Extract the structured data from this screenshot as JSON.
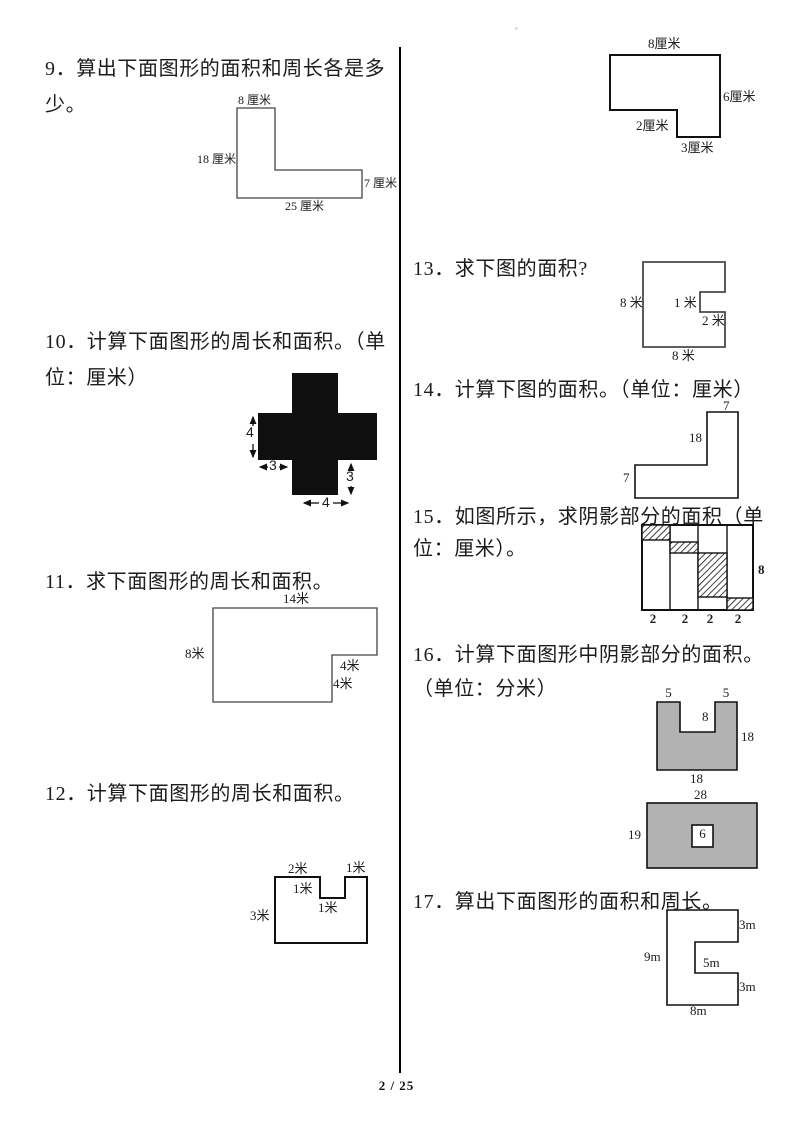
{
  "page_number": "2 / 25",
  "q9": {
    "line1": "9．算出下面图形的面积和周长各是多",
    "line2": "少。",
    "fig": {
      "top": "8 厘米",
      "left": "18 厘米",
      "right": "7 厘米",
      "bottom": "25 厘米"
    }
  },
  "q10": {
    "line1": "10．计算下面图形的周长和面积。（单",
    "line2": "位：厘米）",
    "fig": {
      "left_arm": "4",
      "left_notch": "3",
      "right_notch": "3",
      "bottom_arm": "4"
    }
  },
  "q11": {
    "line1": "11．求下面图形的周长和面积。",
    "fig": {
      "top": "14米",
      "left": "8米",
      "notch_width": "4米",
      "notch_height": "4米"
    }
  },
  "q12": {
    "line1": "12．计算下面图形的周长和面积。",
    "fig": {
      "top_left": "2米",
      "top_right": "1米",
      "notch_side": "1米",
      "notch_bottom": "1米",
      "left": "3米"
    }
  },
  "fig_top_right": {
    "top": "8厘米",
    "right": "6厘米",
    "step": "2厘米",
    "bottom": "3厘米"
  },
  "q13": {
    "line1": "13．求下图的面积?",
    "fig": {
      "left": "8 米",
      "notch_depth": "1 米",
      "notch_height": "2 米",
      "bottom": "8 米"
    }
  },
  "q14": {
    "line1": "14．计算下图的面积。（单位：厘米）",
    "fig": {
      "top": "7",
      "inner": "18",
      "left": "7"
    }
  },
  "q15": {
    "line1": "15．如图所示，求阴影部分的面积（单",
    "line2": "位：厘米）。",
    "fig": {
      "right": "8",
      "widths": [
        "2",
        "2",
        "2",
        "2"
      ]
    }
  },
  "q16": {
    "line1": "16．计算下面图形中阴影部分的面积。",
    "line2": "（单位：分米）",
    "fig1": {
      "prong_left": "5",
      "prong_right": "5",
      "notch": "8",
      "right": "18",
      "bottom": "18"
    },
    "fig2": {
      "top": "28",
      "left": "19",
      "inner": "6"
    }
  },
  "q17": {
    "line1": "17．算出下面图形的面积和周长。",
    "fig": {
      "top_right": "3m",
      "left": "9m",
      "notch": "5m",
      "bottom_right": "3m",
      "bottom": "8m"
    }
  }
}
